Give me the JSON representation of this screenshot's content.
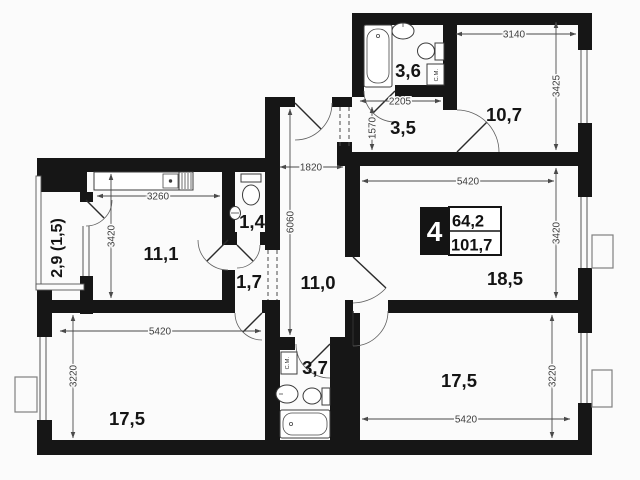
{
  "badge": {
    "room_count": "4",
    "area_living": "64,2",
    "area_total": "101,7"
  },
  "rooms": {
    "bath_top": "3,6",
    "room_top_right": "10,7",
    "hall_top": "3,5",
    "wc": "1,4",
    "kitchen": "11,1",
    "hall_inner": "1,7",
    "corridor": "11,0",
    "living": "18,5",
    "bedroom_left": "17,5",
    "bedroom_right": "17,5",
    "bath_bottom": "3,7",
    "balcony": "2,9 (1,5)"
  },
  "dimensions": {
    "room_top_right_w": "3140",
    "room_top_right_h": "3425",
    "bath_top_w": "2205",
    "hall_top_h": "1570",
    "corridor_w": "1820",
    "corridor_h": "6060",
    "kitchen_w": "3260",
    "kitchen_h": "3420",
    "living_w": "5420",
    "living_h": "3420",
    "bedroom_left_w": "5420",
    "bedroom_left_h": "3220",
    "bedroom_right_w": "5420",
    "bedroom_right_h": "3220"
  },
  "fixtures": {
    "washing_machine": "С.М."
  }
}
